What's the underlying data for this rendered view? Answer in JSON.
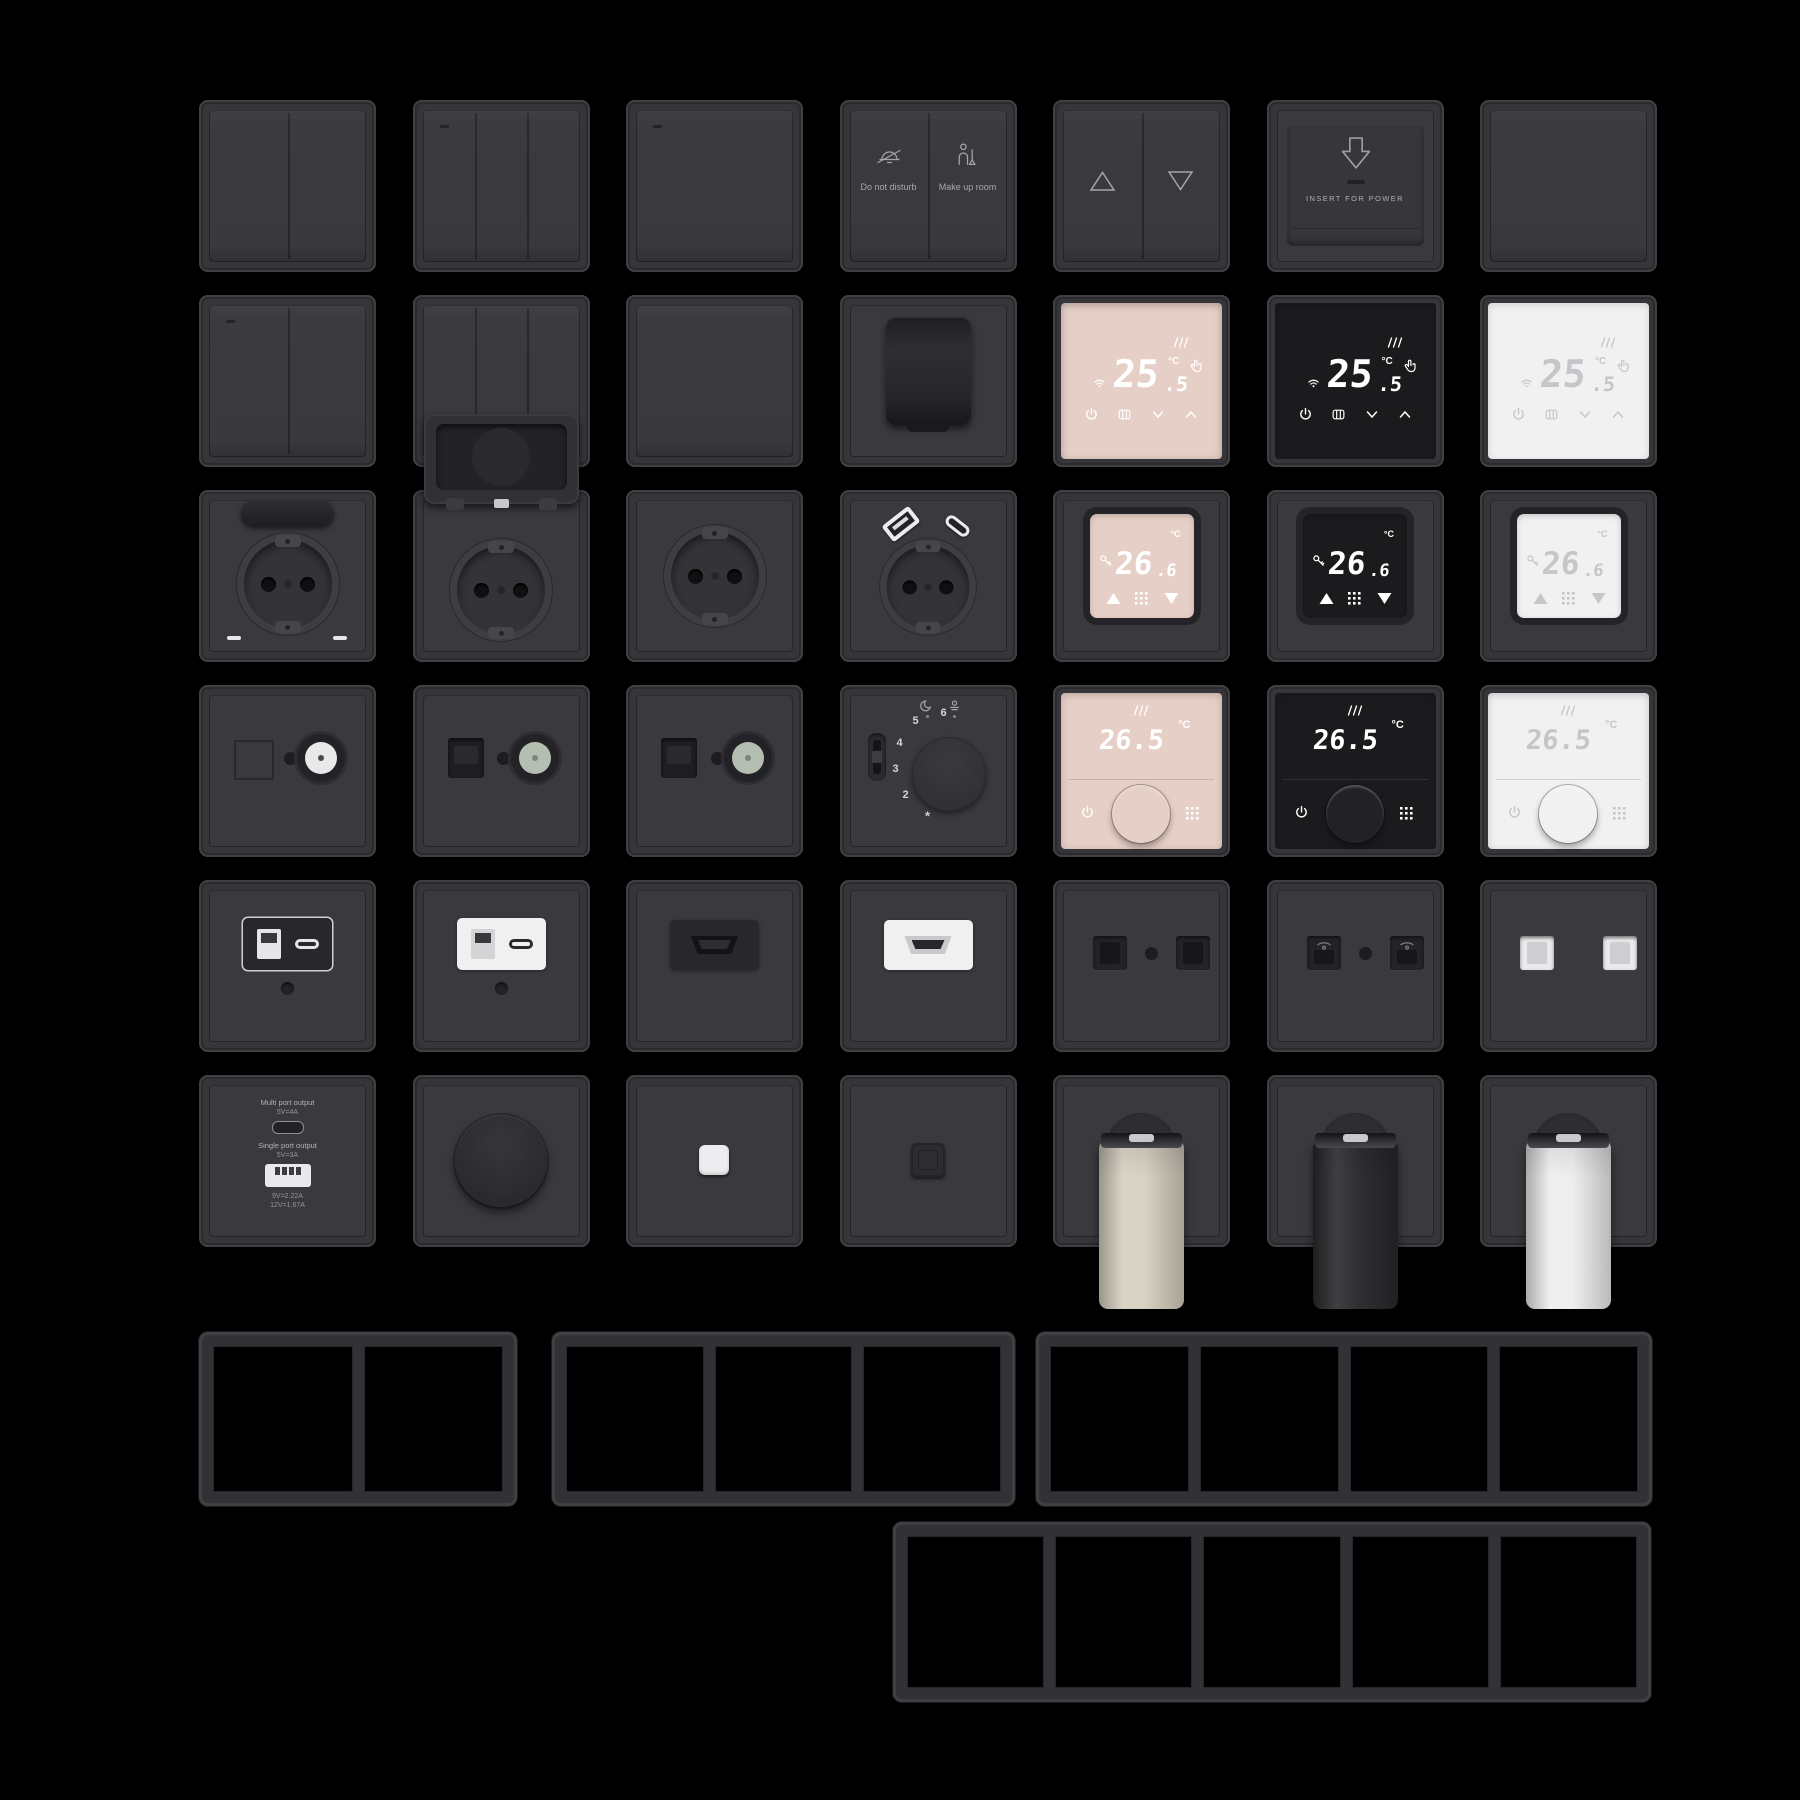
{
  "scene": {
    "background": "#000000",
    "width": 1800,
    "height": 1800
  },
  "palette": {
    "tile": "#36363a",
    "plate": "#3a3a3e",
    "accent_edge": "#404044",
    "label": "#a8a8ab",
    "icon": "#a8a8ab",
    "faces": {
      "rose": "#e6cfc7",
      "black": "#1b1b1e",
      "white": "#f1f1f2"
    },
    "face_digits": {
      "rose": "#ffffff",
      "black": "#ffffff",
      "white": "#c6c6ca"
    },
    "valves": {
      "cream": "#d7d0c1",
      "black": "#2a2a2d",
      "white": "#eeeeef"
    },
    "coax": {
      "white": "#e9e9ea",
      "green": "#b4bfb1"
    },
    "inserts": {
      "dark": "#28282c",
      "white": "#f0f0f1"
    }
  },
  "grid": {
    "origin_x": 199,
    "origin_y": 100,
    "pitch_x": 213.5,
    "pitch_y": 195,
    "tile_w": 177,
    "tile_h": 172
  },
  "texts": {
    "hotel": {
      "left": "Do not disturb",
      "right": "Make up room"
    },
    "card": {
      "label": "INSERT FOR POWER"
    },
    "charger": {
      "multi_title": "Multi port output",
      "multi_spec": "5V=4A",
      "single_title": "Single port output",
      "single_spec": "5V=3A",
      "spec2": "9V=2.22A",
      "spec3": "12V=1.67A"
    },
    "thermo_touch": {
      "main": "25",
      "frac": ".5",
      "unit": "°C"
    },
    "thermo_inset": {
      "main": "26",
      "frac": ".6",
      "unit": "°C"
    },
    "thermo_dial": {
      "temp": "26.5",
      "unit": "°C"
    },
    "mech_dial": {
      "numbers": [
        "6",
        "5",
        "4",
        "3",
        "2"
      ],
      "frost": "*"
    }
  },
  "tiles": [
    {
      "id": "switch-2gang",
      "type": "sw",
      "row": 0,
      "col": 0,
      "opts": {
        "gang": 2
      }
    },
    {
      "id": "switch-3gang",
      "type": "sw",
      "row": 0,
      "col": 1,
      "opts": {
        "gang": 3,
        "led": true
      }
    },
    {
      "id": "switch-1gang-indicator",
      "type": "sw",
      "row": 0,
      "col": 2,
      "opts": {
        "gang": 1,
        "led": true
      }
    },
    {
      "id": "hotel-service-switch",
      "type": "hotel",
      "row": 0,
      "col": 3,
      "opts": {}
    },
    {
      "id": "curtain-switch",
      "type": "curtain",
      "row": 0,
      "col": 4,
      "opts": {}
    },
    {
      "id": "key-card-holder",
      "type": "card",
      "row": 0,
      "col": 5,
      "opts": {}
    },
    {
      "id": "blank-plate",
      "type": "blank",
      "row": 0,
      "col": 6,
      "opts": {}
    },
    {
      "id": "switch-2gang-indicator",
      "type": "sw",
      "row": 1,
      "col": 0,
      "opts": {
        "gang": 2,
        "led": true
      }
    },
    {
      "id": "switch-3gang-b",
      "type": "sw",
      "row": 1,
      "col": 1,
      "opts": {
        "gang": 3
      }
    },
    {
      "id": "switch-1gang",
      "type": "sw",
      "row": 1,
      "col": 2,
      "opts": {
        "gang": 1
      }
    },
    {
      "id": "covered-socket",
      "type": "coveredSocket",
      "row": 1,
      "col": 3,
      "opts": {}
    },
    {
      "id": "thermostat-touch-rose",
      "type": "thermoTouch",
      "row": 1,
      "col": 4,
      "opts": {
        "variant": "rose"
      }
    },
    {
      "id": "thermostat-touch-black",
      "type": "thermoTouch",
      "row": 1,
      "col": 5,
      "opts": {
        "variant": "black"
      }
    },
    {
      "id": "thermostat-touch-white",
      "type": "thermoTouch",
      "row": 1,
      "col": 6,
      "opts": {
        "variant": "white"
      }
    },
    {
      "id": "socket-lid-closed",
      "type": "socketLidClosed",
      "row": 2,
      "col": 0,
      "opts": {}
    },
    {
      "id": "socket-lid-open",
      "type": "socketLidOpen",
      "row": 2,
      "col": 1,
      "opts": {}
    },
    {
      "id": "socket-schuko",
      "type": "socketPlain",
      "row": 2,
      "col": 2,
      "opts": {}
    },
    {
      "id": "socket-usb",
      "type": "socketUsb",
      "row": 2,
      "col": 3,
      "opts": {}
    },
    {
      "id": "thermostat-display-rose",
      "type": "thermoInset",
      "row": 2,
      "col": 4,
      "opts": {
        "variant": "rose"
      }
    },
    {
      "id": "thermostat-display-black",
      "type": "thermoInset",
      "row": 2,
      "col": 5,
      "opts": {
        "variant": "black"
      }
    },
    {
      "id": "thermostat-display-white",
      "type": "thermoInset",
      "row": 2,
      "col": 6,
      "opts": {
        "variant": "white"
      }
    },
    {
      "id": "tv-socket",
      "type": "tv",
      "row": 3,
      "col": 0,
      "opts": {
        "variant": "white",
        "square": "outline"
      }
    },
    {
      "id": "tv-data-socket-1",
      "type": "tv",
      "row": 3,
      "col": 1,
      "opts": {
        "variant": "green",
        "square": "dark"
      }
    },
    {
      "id": "tv-data-socket-2",
      "type": "tv",
      "row": 3,
      "col": 2,
      "opts": {
        "variant": "green",
        "square": "dark"
      }
    },
    {
      "id": "thermostat-mechanical",
      "type": "thermoMech",
      "row": 3,
      "col": 3,
      "opts": {}
    },
    {
      "id": "thermostat-knob-rose",
      "type": "thermoKnob",
      "row": 3,
      "col": 4,
      "opts": {
        "variant": "rose"
      }
    },
    {
      "id": "thermostat-knob-black",
      "type": "thermoKnob",
      "row": 3,
      "col": 5,
      "opts": {
        "variant": "black"
      }
    },
    {
      "id": "thermostat-knob-white",
      "type": "thermoKnob",
      "row": 3,
      "col": 6,
      "opts": {
        "variant": "white"
      }
    },
    {
      "id": "usb-outlet-dark",
      "type": "usbMod",
      "row": 4,
      "col": 0,
      "opts": {
        "variant": "dark"
      }
    },
    {
      "id": "usb-outlet-white",
      "type": "usbMod",
      "row": 4,
      "col": 1,
      "opts": {
        "variant": "white"
      }
    },
    {
      "id": "hdmi-outlet-dark",
      "type": "hdmiMod",
      "row": 4,
      "col": 2,
      "opts": {
        "variant": "dark"
      }
    },
    {
      "id": "hdmi-outlet-white",
      "type": "hdmiMod",
      "row": 4,
      "col": 3,
      "opts": {
        "variant": "white"
      }
    },
    {
      "id": "data-outlet-dark",
      "type": "dualPort",
      "row": 4,
      "col": 4,
      "opts": {
        "variant": "data"
      }
    },
    {
      "id": "phone-outlet-dark",
      "type": "dualPort",
      "row": 4,
      "col": 5,
      "opts": {
        "variant": "phone"
      }
    },
    {
      "id": "data-outlet-white",
      "type": "dualPort",
      "row": 4,
      "col": 6,
      "opts": {
        "variant": "white"
      }
    },
    {
      "id": "usb-charger-plate",
      "type": "charger",
      "row": 5,
      "col": 0,
      "opts": {}
    },
    {
      "id": "rotary-dimmer",
      "type": "dimmer",
      "row": 5,
      "col": 1,
      "opts": {}
    },
    {
      "id": "pushbutton-white",
      "type": "btn",
      "row": 5,
      "col": 2,
      "opts": {
        "variant": "white"
      }
    },
    {
      "id": "pushbutton-dark",
      "type": "btn",
      "row": 5,
      "col": 3,
      "opts": {
        "variant": "dark"
      }
    },
    {
      "id": "radiator-valve-cream",
      "type": "valve",
      "row": 5,
      "col": 4,
      "opts": {
        "variant": "cream"
      }
    },
    {
      "id": "radiator-valve-black",
      "type": "valve",
      "row": 5,
      "col": 5,
      "opts": {
        "variant": "black"
      }
    },
    {
      "id": "radiator-valve-white",
      "type": "valve",
      "row": 5,
      "col": 6,
      "opts": {
        "variant": "white"
      }
    }
  ],
  "frames": [
    {
      "id": "frame-2gang",
      "slots": 2,
      "x": 199,
      "y": 1332,
      "w": 318,
      "h": 174
    },
    {
      "id": "frame-3gang",
      "slots": 3,
      "x": 552,
      "y": 1332,
      "w": 463,
      "h": 174
    },
    {
      "id": "frame-4gang",
      "slots": 4,
      "x": 1036,
      "y": 1332,
      "w": 616,
      "h": 174
    },
    {
      "id": "frame-5gang",
      "slots": 5,
      "x": 893,
      "y": 1522,
      "w": 758,
      "h": 180
    }
  ]
}
